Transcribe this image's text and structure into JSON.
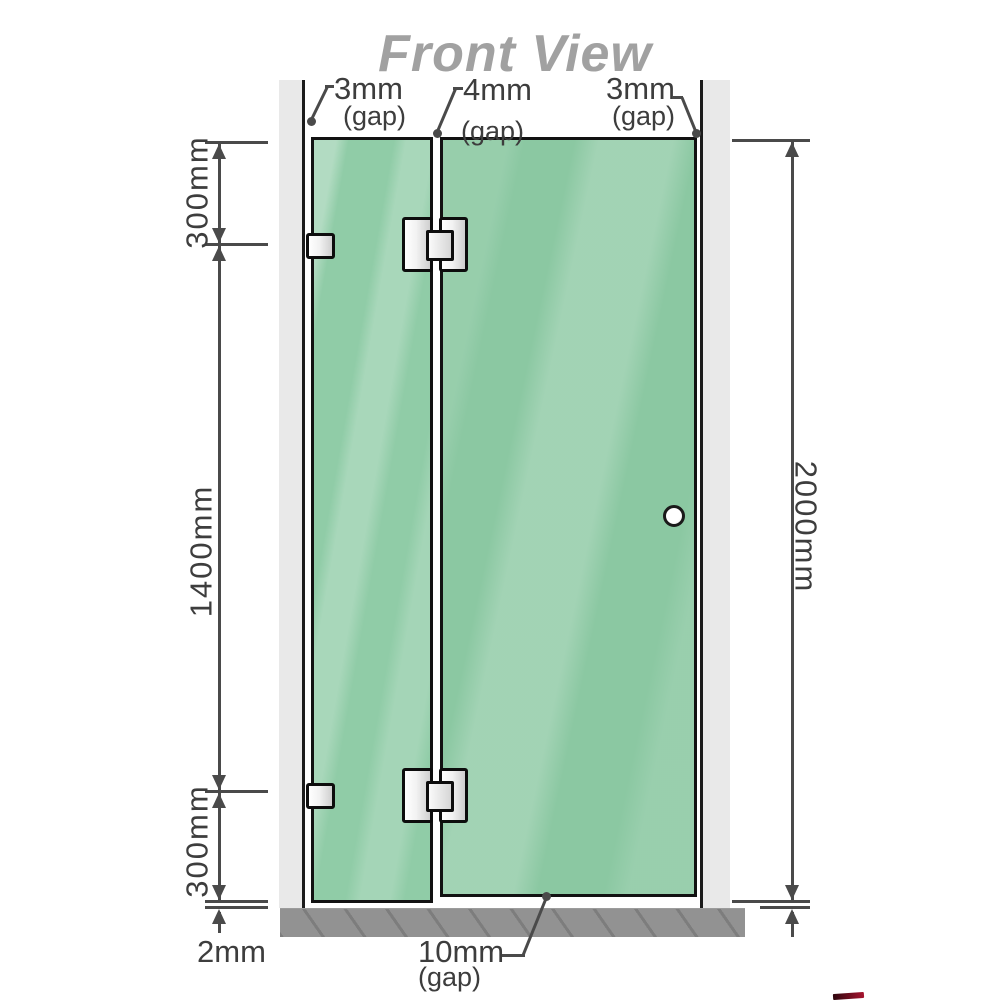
{
  "title": "Front View",
  "dim_left": {
    "top_segment": "300mm",
    "middle_segment": "1400mm",
    "bottom_segment": "300mm",
    "floor_gap": "2mm"
  },
  "dim_right": {
    "total_height": "2000mm"
  },
  "gaps": {
    "left_wall": {
      "value": "3mm",
      "label": "(gap)"
    },
    "between_panels": {
      "value": "4mm",
      "label": "(gap)"
    },
    "right_wall": {
      "value": "3mm",
      "label": "(gap)"
    },
    "door_bottom": {
      "value": "10mm",
      "label": "(gap)"
    }
  },
  "colors": {
    "glass_green": "#8bc8a2",
    "glass_highlight": "#aadcbe",
    "wall_gray": "#e9e9e9",
    "floor_gray": "#8e8e8e",
    "line_gray": "#4a4a4a",
    "title_gray": "#a1a1a1",
    "hardware_silver": "#e8e8e8",
    "accent_red": "#a7142f"
  }
}
